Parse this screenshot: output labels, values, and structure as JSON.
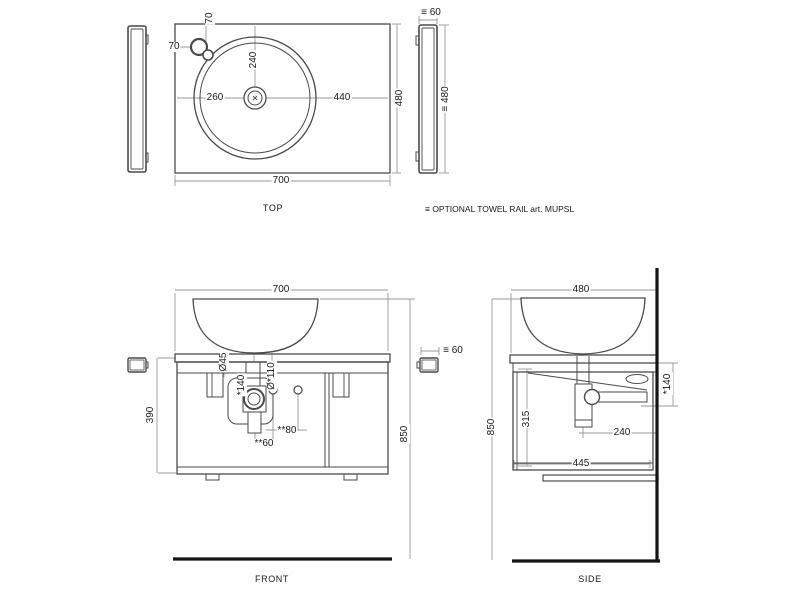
{
  "note": "≡ OPTIONAL TOWEL RAIL art. MUPSL",
  "top_view": {
    "label": "TOP",
    "dim_width": "700",
    "dim_depth": "480",
    "dim_center_from_left": "260",
    "dim_center_to_right": "440",
    "dim_center_from_top": "240",
    "dim_faucet_from_top": "70",
    "dim_faucet_from_left": "70",
    "rail_dim_width": "≡ 60",
    "rail_dim_length": "≡ 480"
  },
  "front_view": {
    "label": "FRONT",
    "dim_width": "700",
    "dim_total_height": "850",
    "dim_cabinet_height": "390",
    "dim_drain_diameter": "Ø45",
    "dim_drain_offset": "*140",
    "dim_hole_diameter": "Ø*110",
    "dim_holes_spacing": "**80",
    "dim_drain_to_hole": "**60",
    "rail_dim_width": "≡ 60"
  },
  "side_view": {
    "label": "SIDE",
    "dim_depth": "480",
    "dim_total_height": "850",
    "dim_interior_height": "315",
    "dim_outlet_drop": "*140",
    "dim_outlet_from_wall": "240",
    "dim_bottom_depth": "445"
  }
}
